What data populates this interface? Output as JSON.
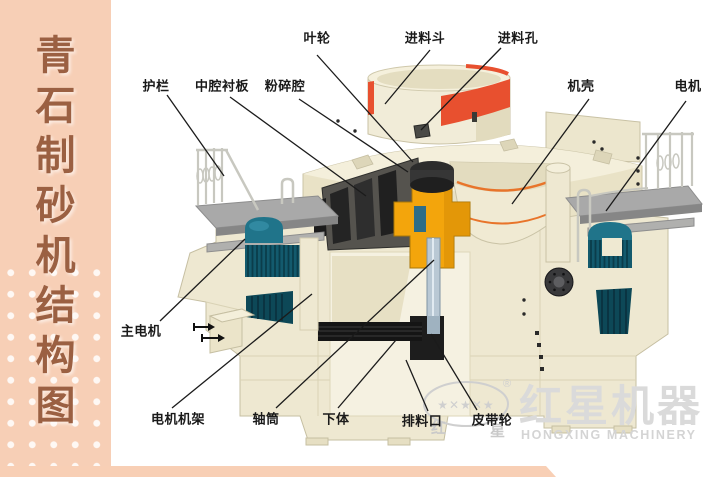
{
  "sidebar": {
    "title": "青石制砂机结构图",
    "chars": [
      "青",
      "石",
      "制",
      "砂",
      "机",
      "结",
      "构",
      "图"
    ]
  },
  "diagram": {
    "labels": [
      {
        "name": "impeller",
        "text": "叶轮",
        "x": 317,
        "y": 37,
        "line": [
          317,
          55,
          413,
          162
        ]
      },
      {
        "name": "feed-hopper",
        "text": "进料斗",
        "x": 425,
        "y": 37,
        "line": [
          430,
          50,
          385,
          104
        ]
      },
      {
        "name": "feed-opening",
        "text": "进料孔",
        "x": 518,
        "y": 37,
        "line": [
          501,
          48,
          421,
          130
        ]
      },
      {
        "name": "guardrail",
        "text": "护栏",
        "x": 156,
        "y": 85,
        "line": [
          167,
          95,
          224,
          176
        ]
      },
      {
        "name": "middle-cavity-liner",
        "text": "中腔衬板",
        "x": 222,
        "y": 85,
        "line": [
          230,
          97,
          366,
          196
        ]
      },
      {
        "name": "crushing-chamber",
        "text": "粉碎腔",
        "x": 285,
        "y": 85,
        "line": [
          299,
          99,
          408,
          172
        ]
      },
      {
        "name": "casing",
        "text": "机壳",
        "x": 581,
        "y": 85,
        "line": [
          589,
          99,
          512,
          204
        ]
      },
      {
        "name": "motor",
        "text": "电机",
        "x": 688,
        "y": 85,
        "line": [
          686,
          101,
          606,
          211
        ]
      },
      {
        "name": "main-motor",
        "text": "主电机",
        "x": 141,
        "y": 330,
        "line": [
          160,
          321,
          245,
          239
        ]
      },
      {
        "name": "motor-frame",
        "text": "电机机架",
        "x": 178,
        "y": 418,
        "line": [
          172,
          408,
          312,
          294
        ]
      },
      {
        "name": "shaft-tube",
        "text": "轴筒",
        "x": 266,
        "y": 418,
        "line": [
          276,
          408,
          434,
          260
        ]
      },
      {
        "name": "lower-body",
        "text": "下体",
        "x": 336,
        "y": 418,
        "line": [
          338,
          408,
          396,
          340
        ]
      },
      {
        "name": "discharge-port",
        "text": "排料口",
        "x": 422,
        "y": 420,
        "line": [
          428,
          411,
          406,
          360
        ]
      },
      {
        "name": "belt-pulley",
        "text": "皮带轮",
        "x": 492,
        "y": 419,
        "line": [
          477,
          410,
          431,
          334
        ]
      }
    ]
  },
  "watermark": {
    "brand_cn": "红星机器",
    "brand_en": "HONGXING MACHINERY",
    "oval_char_left": "红",
    "oval_char_right": "星",
    "stars": "★✕★✕★",
    "registered_mark": "®"
  },
  "colors": {
    "sidebar_bg": "#f7cfb6",
    "sidebar_text": "#9b6042",
    "background": "#ffffff",
    "machine_cream": "#efe9d2",
    "accent_red": "#e8502f",
    "accent_orange": "#e8742a",
    "accent_yellow": "#f3a50c",
    "motor_teal": "#20748a",
    "platform_gray": "#a9a9a9",
    "leader_line": "#1b1b1b",
    "watermark_gray": "#d6d6d6",
    "bottom_strip": "#f8cfb5"
  }
}
